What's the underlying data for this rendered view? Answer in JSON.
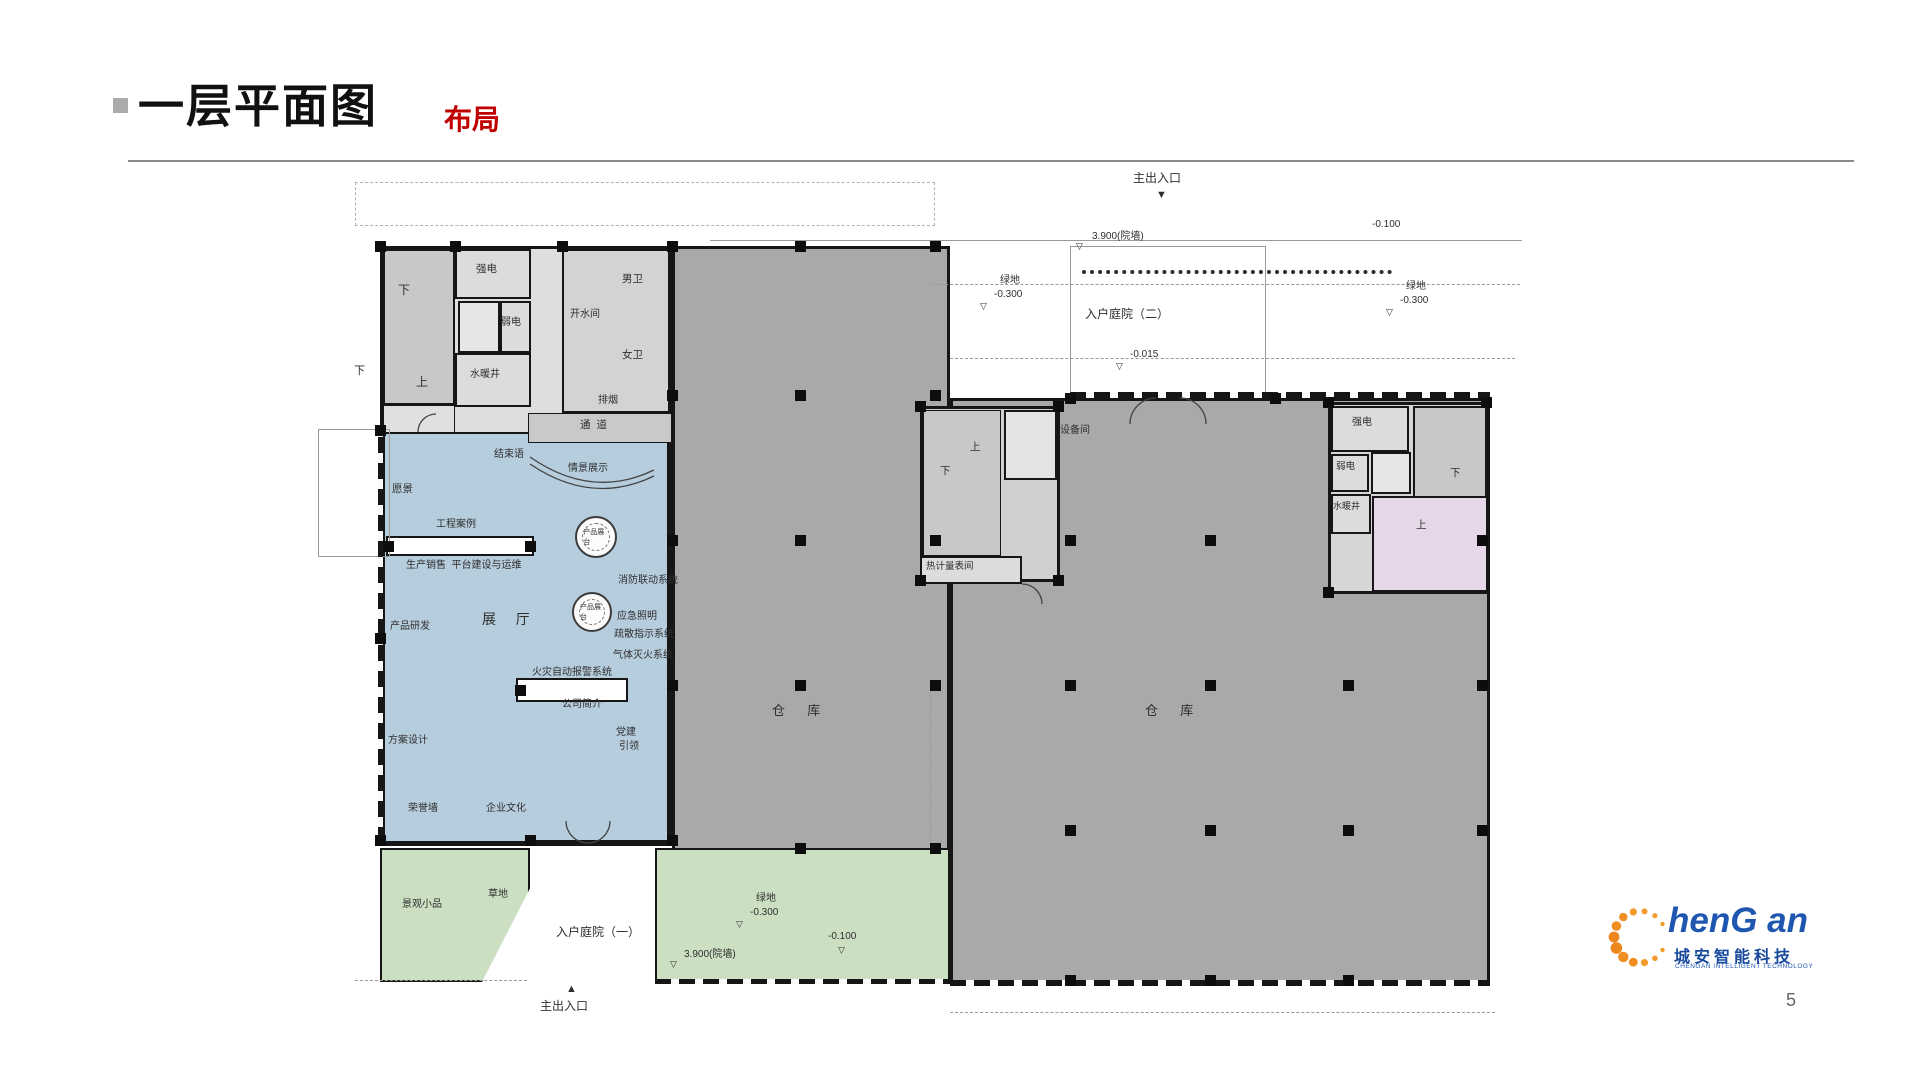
{
  "header": {
    "title": "一层平面图",
    "subtitle": "布局"
  },
  "footer": {
    "page": "5"
  },
  "logo": {
    "brand_rest": "henG an",
    "cn": "城安智能科技",
    "en": "CHENGAN INTELLIGENT TECHNOLOGY"
  },
  "plan": {
    "canvas": {
      "x": 370,
      "y": 180,
      "w": 1150,
      "h": 860
    },
    "areas": [
      {
        "name": "left-building",
        "x": 10,
        "y": 66,
        "w": 292,
        "h": 600,
        "fill": "#dedede",
        "bw": 3
      },
      {
        "name": "showroom",
        "x": 13,
        "y": 252,
        "w": 286,
        "h": 411,
        "fill": "#b6cddd",
        "bw": 2
      },
      {
        "name": "toilet-block",
        "x": 192,
        "y": 69,
        "w": 108,
        "h": 164,
        "fill": "#d3d3d3",
        "bw": 2
      },
      {
        "name": "corridor",
        "x": 158,
        "y": 233,
        "w": 144,
        "h": 30,
        "fill": "#c9c9c9",
        "bw": 1
      },
      {
        "name": "stairwell-left",
        "x": 13,
        "y": 69,
        "w": 72,
        "h": 156,
        "fill": "#c8c8c8",
        "bw": 2,
        "cls": "stairs"
      },
      {
        "name": "room-strong-electric-left",
        "x": 85,
        "y": 69,
        "w": 76,
        "h": 50,
        "fill": "#dcdcdc",
        "bw": 2
      },
      {
        "name": "elevator-left",
        "x": 88,
        "y": 121,
        "w": 42,
        "h": 52,
        "fill": "#e6e6e6",
        "bw": 2,
        "cls": "xbox"
      },
      {
        "name": "room-weak-electric-left",
        "x": 130,
        "y": 121,
        "w": 31,
        "h": 52,
        "fill": "#dcdcdc",
        "bw": 2
      },
      {
        "name": "room-water-shaft-left",
        "x": 85,
        "y": 173,
        "w": 76,
        "h": 54,
        "fill": "#dcdcdc",
        "bw": 2
      },
      {
        "name": "vestibule",
        "x": 13,
        "y": 225,
        "w": 72,
        "h": 28,
        "fill": "#e0e0e0",
        "bw": 1
      },
      {
        "name": "warehouse-mid",
        "x": 302,
        "y": 66,
        "w": 278,
        "h": 606,
        "fill": "#a9a9a9",
        "bw": 3
      },
      {
        "name": "warehouse-right",
        "x": 580,
        "y": 218,
        "w": 540,
        "h": 588,
        "fill": "#a9a9a9",
        "bw": 3
      },
      {
        "name": "entry-courtyard-2",
        "x": 700,
        "y": 66,
        "w": 196,
        "h": 152,
        "fill": "#ffffff",
        "bw": 1,
        "cls": "thin"
      },
      {
        "name": "stair-core-mid",
        "x": 550,
        "y": 226,
        "w": 140,
        "h": 176,
        "fill": "#d0d0d0",
        "bw": 3
      },
      {
        "name": "stairwell-mid",
        "x": 553,
        "y": 230,
        "w": 78,
        "h": 146,
        "fill": "#c8c8c8",
        "bw": 1,
        "cls": "stairs"
      },
      {
        "name": "elevator-mid",
        "x": 634,
        "y": 230,
        "w": 53,
        "h": 70,
        "fill": "#e4e4e4",
        "bw": 2,
        "cls": "xbox"
      },
      {
        "name": "room-heat-meter",
        "x": 550,
        "y": 376,
        "w": 102,
        "h": 28,
        "fill": "#dcdcdc",
        "bw": 2
      },
      {
        "name": "service-core-right",
        "x": 958,
        "y": 222,
        "w": 162,
        "h": 192,
        "fill": "#d6d6d6",
        "bw": 3
      },
      {
        "name": "room-strong-electric-right",
        "x": 961,
        "y": 226,
        "w": 78,
        "h": 46,
        "fill": "#dcdcdc",
        "bw": 2
      },
      {
        "name": "room-weak-electric-right",
        "x": 961,
        "y": 274,
        "w": 38,
        "h": 38,
        "fill": "#dcdcdc",
        "bw": 2
      },
      {
        "name": "elevator-right",
        "x": 1001,
        "y": 272,
        "w": 40,
        "h": 42,
        "fill": "#e6e6e6",
        "bw": 2,
        "cls": "xbox"
      },
      {
        "name": "room-water-shaft-right",
        "x": 961,
        "y": 314,
        "w": 40,
        "h": 40,
        "fill": "#dcdcdc",
        "bw": 2
      },
      {
        "name": "stairwell-right",
        "x": 1043,
        "y": 226,
        "w": 74,
        "h": 122,
        "fill": "#c8c8c8",
        "bw": 2,
        "cls": "stairs"
      },
      {
        "name": "room-pink",
        "x": 1002,
        "y": 316,
        "w": 116,
        "h": 96,
        "fill": "#e5d7e7",
        "bw": 2
      },
      {
        "name": "green-landscape",
        "x": 10,
        "y": 668,
        "w": 150,
        "h": 134,
        "fill": "#cbe0c2",
        "bw": 2,
        "clip": "polygon(0 0,100% 0,100% 30%,68% 100%,0 100%)"
      },
      {
        "name": "green-mid",
        "x": 285,
        "y": 668,
        "w": 295,
        "h": 134,
        "fill": "#cbe0c2",
        "bw": 2
      },
      {
        "name": "display-case-project",
        "x": 16,
        "y": 356,
        "w": 148,
        "h": 20,
        "fill": "#ffffff",
        "bw": 2,
        "cls": "hatch"
      },
      {
        "name": "display-case-company",
        "x": 146,
        "y": 498,
        "w": 112,
        "h": 24,
        "fill": "#ffffff",
        "bw": 2
      },
      {
        "name": "canopy-left",
        "x": -52,
        "y": 249,
        "w": 72,
        "h": 128,
        "fill": "transparent",
        "bw": 1,
        "cls": "thin"
      }
    ],
    "walls": [
      {
        "x": 8,
        "y": 252,
        "w": 5,
        "h": 411,
        "cls": "win-v"
      },
      {
        "x": 700,
        "y": 212,
        "w": 420,
        "h": 6,
        "cls": "win-h"
      },
      {
        "x": 580,
        "y": 800,
        "w": 540,
        "h": 6,
        "cls": "win-h"
      },
      {
        "x": 285,
        "y": 799,
        "w": 295,
        "h": 5,
        "cls": "win-h"
      },
      {
        "x": 160,
        "y": 660,
        "w": 142,
        "h": 4
      },
      {
        "x": 712,
        "y": 90,
        "w": 310,
        "h": 4,
        "cls": "ticks"
      }
    ],
    "lines": [
      {
        "x": 340,
        "y": 60,
        "w": 812,
        "h": 1
      }
    ],
    "dashes": [
      {
        "x": -15,
        "y": 2,
        "w": 580,
        "h": 44,
        "cls": "rect"
      },
      {
        "x": 560,
        "y": 104,
        "w": 590
      },
      {
        "x": 580,
        "y": 178,
        "w": 565
      },
      {
        "x": -15,
        "y": 800,
        "w": 172
      },
      {
        "x": 580,
        "y": 832,
        "w": 545
      },
      {
        "x": 560,
        "y": 505,
        "h": 167
      }
    ],
    "columns": [
      [
        10,
        66
      ],
      [
        85,
        66
      ],
      [
        192,
        66
      ],
      [
        302,
        66
      ],
      [
        430,
        66
      ],
      [
        565,
        66
      ],
      [
        10,
        250
      ],
      [
        10,
        458
      ],
      [
        10,
        660
      ],
      [
        160,
        660
      ],
      [
        302,
        660
      ],
      [
        302,
        215
      ],
      [
        302,
        360
      ],
      [
        302,
        505
      ],
      [
        430,
        215
      ],
      [
        430,
        360
      ],
      [
        430,
        505
      ],
      [
        565,
        215
      ],
      [
        565,
        360
      ],
      [
        565,
        505
      ],
      [
        430,
        668
      ],
      [
        565,
        668
      ],
      [
        700,
        218
      ],
      [
        905,
        218
      ],
      [
        700,
        360
      ],
      [
        700,
        505
      ],
      [
        700,
        650
      ],
      [
        840,
        360
      ],
      [
        840,
        505
      ],
      [
        840,
        650
      ],
      [
        978,
        505
      ],
      [
        978,
        650
      ],
      [
        1112,
        360
      ],
      [
        1112,
        505
      ],
      [
        1112,
        650
      ],
      [
        700,
        800
      ],
      [
        840,
        800
      ],
      [
        978,
        800
      ],
      [
        550,
        226
      ],
      [
        688,
        226
      ],
      [
        550,
        400
      ],
      [
        688,
        400
      ],
      [
        958,
        222
      ],
      [
        1116,
        222
      ],
      [
        958,
        412
      ],
      [
        18,
        366
      ],
      [
        160,
        366
      ],
      [
        150,
        510
      ]
    ],
    "circles": [
      {
        "x": 205,
        "y": 336,
        "d": 42,
        "t": "产品展台"
      },
      {
        "x": 202,
        "y": 412,
        "d": 40,
        "t": "产品展台"
      }
    ],
    "labels": [
      {
        "t": "下",
        "x": 28,
        "y": 104,
        "fs": 12
      },
      {
        "t": "上",
        "x": 46,
        "y": 196,
        "fs": 12
      },
      {
        "t": "强电",
        "x": 106,
        "y": 84
      },
      {
        "t": "弱电",
        "x": 131,
        "y": 138,
        "fs": 10
      },
      {
        "t": "水暖井",
        "x": 100,
        "y": 190,
        "fs": 10
      },
      {
        "t": "开水间",
        "x": 200,
        "y": 130,
        "fs": 10
      },
      {
        "t": "男卫",
        "x": 252,
        "y": 94
      },
      {
        "t": "女卫",
        "x": 252,
        "y": 170
      },
      {
        "t": "排烟",
        "x": 228,
        "y": 216,
        "fs": 10
      },
      {
        "t": "通道",
        "x": 210,
        "y": 240,
        "ls": 6
      },
      {
        "t": "结束语",
        "x": 124,
        "y": 270,
        "fs": 10
      },
      {
        "t": "情景展示",
        "x": 198,
        "y": 284,
        "fs": 10
      },
      {
        "t": "愿景",
        "x": 22,
        "y": 304
      },
      {
        "t": "工程案例",
        "x": 66,
        "y": 340,
        "fs": 10
      },
      {
        "t": "生产销售  平台建设与运维",
        "x": 36,
        "y": 381,
        "fs": 10
      },
      {
        "t": "产品研发",
        "x": 20,
        "y": 442,
        "fs": 10
      },
      {
        "t": "展  厅",
        "x": 112,
        "y": 432,
        "fs": 14,
        "ls": 4
      },
      {
        "t": "消防联动系统",
        "x": 248,
        "y": 396,
        "fs": 10
      },
      {
        "t": "应急照明",
        "x": 247,
        "y": 432,
        "fs": 10
      },
      {
        "t": "疏散指示系统",
        "x": 244,
        "y": 450,
        "fs": 10
      },
      {
        "t": "气体灭火系统",
        "x": 243,
        "y": 471,
        "fs": 10
      },
      {
        "t": "火灾自动报警系统",
        "x": 162,
        "y": 488,
        "fs": 10
      },
      {
        "t": "公司简介",
        "x": 192,
        "y": 520,
        "fs": 10
      },
      {
        "t": "党建",
        "x": 246,
        "y": 548,
        "fs": 10
      },
      {
        "t": "引领",
        "x": 249,
        "y": 562,
        "fs": 10
      },
      {
        "t": "方案设计",
        "x": 18,
        "y": 556,
        "fs": 10
      },
      {
        "t": "荣誉墙",
        "x": 38,
        "y": 624,
        "fs": 10
      },
      {
        "t": "企业文化",
        "x": 116,
        "y": 624,
        "fs": 10
      },
      {
        "t": "仓  库",
        "x": 402,
        "y": 524,
        "fs": 13,
        "ls": 5
      },
      {
        "t": "仓  库",
        "x": 775,
        "y": 524,
        "fs": 13,
        "ls": 5
      },
      {
        "t": "设备间",
        "x": 690,
        "y": 246,
        "fs": 10
      },
      {
        "t": "热计量表间",
        "x": 556,
        "y": 382,
        "fs": 9.5
      },
      {
        "t": "上",
        "x": 600,
        "y": 262
      },
      {
        "t": "下",
        "x": 570,
        "y": 286
      },
      {
        "t": "强电",
        "x": 982,
        "y": 238,
        "fs": 10
      },
      {
        "t": "弱电",
        "x": 966,
        "y": 282,
        "fs": 9.5
      },
      {
        "t": "水暖井",
        "x": 963,
        "y": 322,
        "fs": 9
      },
      {
        "t": "下",
        "x": 1080,
        "y": 288
      },
      {
        "t": "上",
        "x": 1046,
        "y": 340
      },
      {
        "t": "入户庭院（二）",
        "x": 715,
        "y": 128,
        "fs": 12
      },
      {
        "t": "主出入口",
        "x": 763,
        "y": -8,
        "fs": 12
      },
      {
        "t": "▼",
        "x": 786,
        "y": 10,
        "fs": 11
      },
      {
        "t": "3.900(院墙)",
        "x": 722,
        "y": 52,
        "fs": 10
      },
      {
        "t": "▽",
        "x": 706,
        "y": 62,
        "fs": 9
      },
      {
        "t": "-0.100",
        "x": 1002,
        "y": 40,
        "fs": 10
      },
      {
        "t": "绿地",
        "x": 630,
        "y": 96,
        "fs": 10
      },
      {
        "t": "-0.300",
        "x": 624,
        "y": 110,
        "fs": 10
      },
      {
        "t": "▽",
        "x": 610,
        "y": 122,
        "fs": 9
      },
      {
        "t": "绿地",
        "x": 1036,
        "y": 102,
        "fs": 10
      },
      {
        "t": "-0.300",
        "x": 1030,
        "y": 116,
        "fs": 10
      },
      {
        "t": "▽",
        "x": 1016,
        "y": 128,
        "fs": 9
      },
      {
        "t": "-0.015",
        "x": 760,
        "y": 170,
        "fs": 10
      },
      {
        "t": "▽",
        "x": 746,
        "y": 182,
        "fs": 9
      },
      {
        "t": "景观小品",
        "x": 32,
        "y": 720,
        "fs": 10
      },
      {
        "t": "草地",
        "x": 118,
        "y": 710,
        "fs": 10
      },
      {
        "t": "入户庭院（一）",
        "x": 186,
        "y": 746,
        "fs": 12
      },
      {
        "t": "绿地",
        "x": 386,
        "y": 714,
        "fs": 10
      },
      {
        "t": "-0.300",
        "x": 380,
        "y": 728,
        "fs": 10
      },
      {
        "t": "▽",
        "x": 366,
        "y": 740,
        "fs": 9
      },
      {
        "t": "3.900(院墙)",
        "x": 314,
        "y": 770,
        "fs": 10
      },
      {
        "t": "▽",
        "x": 300,
        "y": 780,
        "fs": 9
      },
      {
        "t": "-0.100",
        "x": 458,
        "y": 752,
        "fs": 10
      },
      {
        "t": "▽",
        "x": 468,
        "y": 766,
        "fs": 9
      },
      {
        "t": "主出入口",
        "x": 170,
        "y": 820,
        "fs": 12
      },
      {
        "t": "▲",
        "x": 196,
        "y": 804,
        "fs": 11
      },
      {
        "t": "下",
        "x": -16,
        "y": 186,
        "fs": 11
      }
    ],
    "svg_paths": [
      "M160,277 Q222,320 284,290",
      "M160,284 Q222,326 284,296",
      "M218,663 A22,22 0 0 1 196,641",
      "M218,663 A22,22 0 0 0 240,641",
      "M786,218 A26,26 0 0 0 760,244",
      "M810,218 A26,26 0 0 1 836,244",
      "M48,252 A18,18 0 0 1 66,234",
      "M652,404 A20,20 0 0 1 672,424"
    ]
  }
}
